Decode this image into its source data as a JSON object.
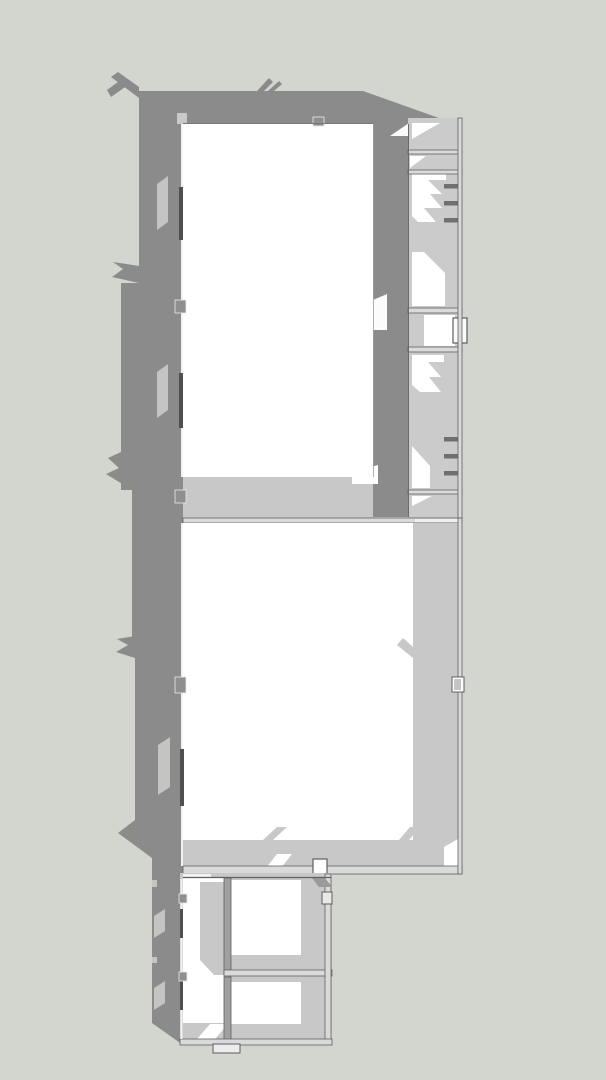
{
  "meta": {
    "view_label": "top-down-architectural-model-view",
    "canvas": {
      "width": 606,
      "height": 1080
    }
  },
  "palette": {
    "background": "#d3d5cf",
    "cast_shadow": "#8b8b8b",
    "interior_shade": "#c8c8c8",
    "room_gray": "#cbcbcb",
    "wall_top": "#dadada",
    "floor_white": "#ffffff",
    "floor_soft": "#fbfbfb",
    "outline": "#5f5f5f",
    "window_streak": "#c4c4c2",
    "stair_dash": "#6f6f6f",
    "wall_post": "#8f8f8f",
    "post_light": "#c4c4c4",
    "window_bar": "#4f4f4f"
  },
  "shapes": [
    {
      "n": "ground-background",
      "t": "rect",
      "x": 0,
      "y": 0,
      "w": 606,
      "h": 1080,
      "f": "#d3d5cf"
    },
    {
      "n": "cast-shadow-main",
      "t": "poly",
      "p": "139,91 363,91 450,122 462,122 462,124 408,124 408,517 373,517 373,124 183,124 183,1045 152,1023 152,858 118,833 135,820 135,655 132,655 132,490 121,490 121,283 139,283",
      "f": "#8b8b8b"
    },
    {
      "n": "shadow-spike-top-corner-a",
      "t": "poly",
      "p": "139,98 111,77 118,72 139,87",
      "f": "#8b8b8b"
    },
    {
      "n": "shadow-spike-top-corner-b",
      "t": "poly",
      "p": "128,85 111,97 107,90 122,79",
      "f": "#8b8b8b"
    },
    {
      "n": "shadow-spike-top-edge-a",
      "t": "poly",
      "p": "257,91 269,78 273,82 264,91",
      "f": "#8b8b8b"
    },
    {
      "n": "shadow-spike-top-edge-b",
      "t": "poly",
      "p": "268,91 279,81 282,84 274,91",
      "f": "#8b8b8b"
    },
    {
      "n": "shadow-spike-left-1",
      "t": "poly",
      "p": "139,283 112,277 123,269 113,262 139,266",
      "f": "#8b8b8b"
    },
    {
      "n": "shadow-spike-left-2",
      "t": "poly",
      "p": "132,490 106,474 119,468 108,458 121,452 132,466",
      "f": "#8b8b8b"
    },
    {
      "n": "shadow-spike-left-3",
      "t": "poly",
      "p": "135,658 116,652 128,645 117,639 135,636",
      "f": "#8b8b8b"
    },
    {
      "n": "window-light-streak-1",
      "t": "poly",
      "p": "157,184 168,176 168,222 157,230",
      "f": "#c4c4c2"
    },
    {
      "n": "window-light-streak-2",
      "t": "poly",
      "p": "157,372 168,364 168,410 157,418",
      "f": "#c4c4c2"
    },
    {
      "n": "window-light-streak-3",
      "t": "poly",
      "p": "158,745 170,737 170,787 158,795",
      "f": "#c4c4c2"
    },
    {
      "n": "window-light-streak-4",
      "t": "poly",
      "p": "154,916 165,909 165,931 154,938",
      "f": "#c4c4c2"
    },
    {
      "n": "window-light-streak-5",
      "t": "poly",
      "p": "154,988 165,981 165,1003 154,1010",
      "f": "#c4c4c2"
    },
    {
      "n": "window-light-notch-1",
      "t": "rect",
      "x": 152,
      "y": 880,
      "w": 5,
      "h": 7,
      "f": "#c4c4c2"
    },
    {
      "n": "window-light-notch-2",
      "t": "rect",
      "x": 152,
      "y": 957,
      "w": 5,
      "h": 6,
      "f": "#c4c4c2"
    },
    {
      "n": "wall-step-top-left",
      "t": "rect",
      "x": 177,
      "y": 113,
      "w": 10,
      "h": 11,
      "f": "#c9c9c9"
    },
    {
      "n": "north-room-floor",
      "t": "rect",
      "x": 183,
      "y": 123,
      "w": 190,
      "h": 354,
      "f": "#ffffff"
    },
    {
      "n": "north-room-south-shade-band",
      "t": "rect",
      "x": 183,
      "y": 477,
      "w": 190,
      "h": 41,
      "f": "#c8c8c8"
    },
    {
      "n": "north-room-light-gap-wedge",
      "t": "poly",
      "p": "352,484 352,472 378,465 378,484",
      "f": "#ffffff"
    },
    {
      "n": "passage-light-patch",
      "t": "poly",
      "p": "373,330 373,300 387,294 387,330",
      "f": "#fbfbfb"
    },
    {
      "n": "passage-top-light-wedge",
      "t": "poly",
      "p": "390,136 412,121 412,136",
      "f": "#fbfbfb"
    },
    {
      "n": "east-wing-base",
      "t": "rect",
      "x": 408,
      "y": 118,
      "w": 54,
      "h": 400,
      "f": "#cbcbcb"
    },
    {
      "n": "east-wing-room-a-light",
      "t": "poly",
      "p": "412,123 440,123 412,139",
      "f": "#ffffff"
    },
    {
      "n": "east-wing-room-b-light",
      "t": "poly",
      "p": "410,156 426,156 410,168",
      "f": "#ffffff"
    },
    {
      "n": "east-wing-room-c-light-zigzag",
      "t": "poly",
      "p": "412,174 446,174 446,180 428,180 442,194 430,194 442,208 424,208 436,222 418,222 412,216",
      "f": "#ffffff"
    },
    {
      "n": "east-wing-room-c-light-lower",
      "t": "poly",
      "p": "412,252 424,252 445,273 445,306 412,306",
      "f": "#ffffff"
    },
    {
      "n": "east-wing-room-d-floor",
      "t": "rect",
      "x": 424,
      "y": 315,
      "w": 31,
      "h": 31,
      "f": "#ffffff"
    },
    {
      "n": "east-wing-bay-window",
      "t": "rect",
      "x": 453,
      "y": 318,
      "w": 14,
      "h": 25,
      "f": "#fbfbfb",
      "s": "#5f5f5f",
      "sw": 1.2
    },
    {
      "n": "east-wing-room-e-light-zigzag",
      "t": "poly",
      "p": "412,355 444,355 444,362 428,362 441,377 429,377 441,392 420,392 412,385",
      "f": "#ffffff"
    },
    {
      "n": "east-wing-room-e-light-lower",
      "t": "poly",
      "p": "412,446 430,466 430,488 412,488",
      "f": "#ffffff"
    },
    {
      "n": "east-wing-room-f-light",
      "t": "poly",
      "p": "412,496 432,496 412,506",
      "f": "#ffffff"
    },
    {
      "n": "east-wing-wall-ab",
      "t": "rect",
      "x": 408,
      "y": 150,
      "w": 54,
      "h": 4,
      "f": "#dadada",
      "s": "#5f5f5f",
      "sw": 0.8
    },
    {
      "n": "east-wing-wall-bc",
      "t": "rect",
      "x": 408,
      "y": 170,
      "w": 54,
      "h": 4,
      "f": "#dadada",
      "s": "#5f5f5f",
      "sw": 0.8
    },
    {
      "n": "east-wing-wall-cd",
      "t": "rect",
      "x": 408,
      "y": 308,
      "w": 54,
      "h": 5,
      "f": "#dadada",
      "s": "#5f5f5f",
      "sw": 0.8
    },
    {
      "n": "east-wing-wall-de",
      "t": "rect",
      "x": 408,
      "y": 347,
      "w": 54,
      "h": 5,
      "f": "#dadada",
      "s": "#5f5f5f",
      "sw": 0.8
    },
    {
      "n": "east-wing-wall-ef",
      "t": "rect",
      "x": 408,
      "y": 490,
      "w": 54,
      "h": 4,
      "f": "#dadada",
      "s": "#5f5f5f",
      "sw": 0.8
    },
    {
      "n": "stair-tread-1",
      "t": "rect",
      "x": 444,
      "y": 184,
      "w": 14,
      "h": 4.5,
      "f": "#6f6f6f"
    },
    {
      "n": "stair-tread-2",
      "t": "rect",
      "x": 444,
      "y": 201,
      "w": 14,
      "h": 4.5,
      "f": "#6f6f6f"
    },
    {
      "n": "stair-tread-3",
      "t": "rect",
      "x": 444,
      "y": 218,
      "w": 14,
      "h": 4.5,
      "f": "#6f6f6f"
    },
    {
      "n": "stair-tread-4",
      "t": "rect",
      "x": 444,
      "y": 437,
      "w": 14,
      "h": 4.5,
      "f": "#6f6f6f"
    },
    {
      "n": "stair-tread-5",
      "t": "rect",
      "x": 444,
      "y": 454,
      "w": 14,
      "h": 4.5,
      "f": "#6f6f6f"
    },
    {
      "n": "stair-tread-6",
      "t": "rect",
      "x": 444,
      "y": 471,
      "w": 14,
      "h": 4.5,
      "f": "#6f6f6f"
    },
    {
      "n": "east-wing-east-wall",
      "t": "rect",
      "x": 458,
      "y": 118,
      "w": 4,
      "h": 400,
      "f": "#dadada",
      "s": "#5f5f5f",
      "sw": 0.8
    },
    {
      "n": "east-wing-west-wall-line",
      "t": "line",
      "x1": 408.5,
      "y1": 124,
      "x2": 408.5,
      "y2": 517,
      "s": "#6a6a6a",
      "sw": 1
    },
    {
      "n": "north-room-east-wall-line",
      "t": "line",
      "x1": 373.5,
      "y1": 124,
      "x2": 373.5,
      "y2": 477,
      "s": "#9e9e9e",
      "sw": 0.8
    },
    {
      "n": "cross-wall-north",
      "t": "rect",
      "x": 183,
      "y": 518,
      "w": 279,
      "h": 5,
      "f": "#dadada",
      "s": "#5f5f5f",
      "sw": 0.8
    },
    {
      "n": "cross-wall-light-gap",
      "t": "rect",
      "x": 415,
      "y": 519,
      "w": 43,
      "h": 3,
      "f": "#f0f0f0"
    },
    {
      "n": "main-hall-floor",
      "t": "rect",
      "x": 183,
      "y": 523,
      "w": 275,
      "h": 345,
      "f": "#ffffff"
    },
    {
      "n": "main-hall-east-shade-band",
      "t": "rect",
      "x": 413,
      "y": 523,
      "w": 45,
      "h": 345,
      "f": "#c8c8c8"
    },
    {
      "n": "main-hall-south-shade-band",
      "t": "rect",
      "x": 183,
      "y": 840,
      "w": 275,
      "h": 28,
      "f": "#c8c8c8"
    },
    {
      "n": "shade-chevron-east",
      "t": "poly",
      "p": "413,658 397,645 403,638 413,647",
      "f": "#c8c8c8"
    },
    {
      "n": "shade-chevron-south-a",
      "t": "poly",
      "p": "263,840 277,827 287,827 273,840",
      "f": "#c8c8c8"
    },
    {
      "n": "shade-chevron-south-b",
      "t": "poly",
      "p": "399,840 410,827 420,827 409,840",
      "f": "#c8c8c8"
    },
    {
      "n": "door-light-wedge-south",
      "t": "poly",
      "p": "266,868 277,854 292,854 281,868",
      "f": "#ffffff"
    },
    {
      "n": "corner-light-wedge-se",
      "t": "poly",
      "p": "444,868 444,847 458,839 458,868",
      "f": "#ffffff"
    },
    {
      "n": "main-hall-south-wall",
      "t": "rect",
      "x": 183,
      "y": 866,
      "w": 279,
      "h": 8,
      "f": "#dadada",
      "s": "#5f5f5f",
      "sw": 0.8
    },
    {
      "n": "main-hall-east-wall",
      "t": "rect",
      "x": 458,
      "y": 518,
      "w": 4,
      "h": 356,
      "f": "#dadada",
      "s": "#5f5f5f",
      "sw": 0.8
    },
    {
      "n": "south-door-notch",
      "t": "rect",
      "x": 313,
      "y": 859,
      "w": 14,
      "h": 15,
      "f": "#ffffff",
      "s": "#5f5f5f",
      "sw": 1.2
    },
    {
      "n": "east-wall-post",
      "t": "rect",
      "x": 452,
      "y": 677,
      "w": 12,
      "h": 15,
      "f": "#ffffff",
      "s": "#5f5f5f",
      "sw": 1
    },
    {
      "n": "east-wall-post-core",
      "t": "rect",
      "x": 454,
      "y": 679,
      "w": 7,
      "h": 11,
      "f": "#c4c4c4"
    },
    {
      "n": "annex-base",
      "t": "rect",
      "x": 180,
      "y": 873,
      "w": 152,
      "h": 172,
      "f": "#c8c8c8"
    },
    {
      "n": "annex-north-gap",
      "t": "rect",
      "x": 183,
      "y": 874,
      "w": 28,
      "h": 4,
      "f": "#f2f2f2"
    },
    {
      "n": "annex-west-floor",
      "t": "rect",
      "x": 183,
      "y": 878,
      "w": 45,
      "h": 145,
      "f": "#ffffff"
    },
    {
      "n": "annex-west-shade",
      "t": "poly",
      "p": "200,882 228,882 228,975 214,975 200,960",
      "f": "#c8c8c8"
    },
    {
      "n": "annex-sw-light-wedge",
      "t": "poly",
      "p": "197,1039 210,1024 228,1024 215,1039",
      "f": "#ffffff"
    },
    {
      "n": "annex-room-ne-floor",
      "t": "rect",
      "x": 231,
      "y": 880,
      "w": 70,
      "h": 75,
      "f": "#ffffff"
    },
    {
      "n": "annex-room-ne-west-wall",
      "t": "rect",
      "x": 224,
      "y": 878,
      "w": 7,
      "h": 97,
      "f": "#a0a0a0",
      "s": "#5f5f5f",
      "sw": 0.8
    },
    {
      "n": "annex-room-ne-south-wall",
      "t": "rect",
      "x": 224,
      "y": 970,
      "w": 108,
      "h": 6,
      "f": "#dadada",
      "s": "#5f5f5f",
      "sw": 0.8
    },
    {
      "n": "annex-room-se-floor",
      "t": "rect",
      "x": 231,
      "y": 982,
      "w": 70,
      "h": 42,
      "f": "#ffffff"
    },
    {
      "n": "annex-room-se-west-wall",
      "t": "rect",
      "x": 224,
      "y": 977,
      "w": 7,
      "h": 66,
      "f": "#a0a0a0",
      "s": "#5f5f5f",
      "sw": 0.8
    },
    {
      "n": "annex-east-wall",
      "t": "rect",
      "x": 325,
      "y": 874,
      "w": 6,
      "h": 170,
      "f": "#dadada",
      "s": "#5f5f5f",
      "sw": 0.8
    },
    {
      "n": "annex-door-shadow",
      "t": "poly",
      "p": "312,878 325,878 332,887 319,887",
      "f": "#9a9a9a"
    },
    {
      "n": "annex-east-wall-post",
      "t": "rect",
      "x": 322,
      "y": 892,
      "w": 10,
      "h": 12,
      "f": "#e9e9e9",
      "s": "#5f5f5f",
      "sw": 1
    },
    {
      "n": "annex-south-wall",
      "t": "rect",
      "x": 180,
      "y": 1039,
      "w": 152,
      "h": 6,
      "f": "#dadada",
      "s": "#5f5f5f",
      "sw": 0.8
    },
    {
      "n": "annex-north-wall-line",
      "t": "line",
      "x1": 183,
      "y1": 877.5,
      "x2": 331,
      "y2": 877.5,
      "s": "#5f5f5f",
      "sw": 1.2
    },
    {
      "n": "entry-stoop",
      "t": "rect",
      "x": 213,
      "y": 1044,
      "w": 27,
      "h": 9,
      "f": "#ececec",
      "s": "#5f5f5f",
      "sw": 1
    },
    {
      "n": "west-wall-top-line-north",
      "t": "line",
      "x1": 182,
      "y1": 124,
      "x2": 182,
      "y2": 477,
      "s": "#f2f2f2",
      "sw": 2
    },
    {
      "n": "west-wall-top-line-mid",
      "t": "line",
      "x1": 182,
      "y1": 523,
      "x2": 182,
      "y2": 866,
      "s": "#f2f2f2",
      "sw": 2
    },
    {
      "n": "west-wall-top-line-annex",
      "t": "line",
      "x1": 181.5,
      "y1": 879,
      "x2": 181.5,
      "y2": 1039,
      "s": "#f2f2f2",
      "sw": 2
    },
    {
      "n": "west-window-bar-1",
      "t": "rect",
      "x": 179,
      "y": 187,
      "w": 4,
      "h": 53,
      "f": "#4f4f4f"
    },
    {
      "n": "west-window-bar-2",
      "t": "rect",
      "x": 179,
      "y": 373,
      "w": 4,
      "h": 55,
      "f": "#4f4f4f"
    },
    {
      "n": "west-window-bar-3",
      "t": "rect",
      "x": 180,
      "y": 749,
      "w": 4,
      "h": 57,
      "f": "#4f4f4f"
    },
    {
      "n": "west-window-bar-4",
      "t": "rect",
      "x": 180,
      "y": 909,
      "w": 3,
      "h": 29,
      "f": "#4f4f4f"
    },
    {
      "n": "west-window-bar-5",
      "t": "rect",
      "x": 180,
      "y": 981,
      "w": 3,
      "h": 29,
      "f": "#4f4f4f"
    },
    {
      "n": "west-wall-post-1",
      "t": "rect",
      "x": 175,
      "y": 300,
      "w": 11,
      "h": 13,
      "f": "#8f8f8f",
      "s": "#eaeaea",
      "sw": 0.8
    },
    {
      "n": "west-wall-post-2",
      "t": "rect",
      "x": 175,
      "y": 490,
      "w": 11,
      "h": 13,
      "f": "#8f8f8f",
      "s": "#eaeaea",
      "sw": 0.8
    },
    {
      "n": "west-wall-post-3",
      "t": "rect",
      "x": 175,
      "y": 677,
      "w": 11,
      "h": 16,
      "f": "#8f8f8f",
      "s": "#eaeaea",
      "sw": 0.8
    },
    {
      "n": "west-wall-post-4",
      "t": "rect",
      "x": 179,
      "y": 894,
      "w": 8,
      "h": 9,
      "f": "#8f8f8f",
      "s": "#eaeaea",
      "sw": 0.8
    },
    {
      "n": "west-wall-post-5",
      "t": "rect",
      "x": 179,
      "y": 972,
      "w": 8,
      "h": 9,
      "f": "#8f8f8f",
      "s": "#eaeaea",
      "sw": 0.8
    },
    {
      "n": "north-wall-post",
      "t": "rect",
      "x": 313,
      "y": 117,
      "w": 11,
      "h": 9,
      "f": "#8f8f8f",
      "s": "#eaeaea",
      "sw": 0.8
    },
    {
      "n": "north-wall-inner-line",
      "t": "line",
      "x1": 183,
      "y1": 123.5,
      "x2": 373,
      "y2": 123.5,
      "s": "#777777",
      "sw": 1
    }
  ]
}
